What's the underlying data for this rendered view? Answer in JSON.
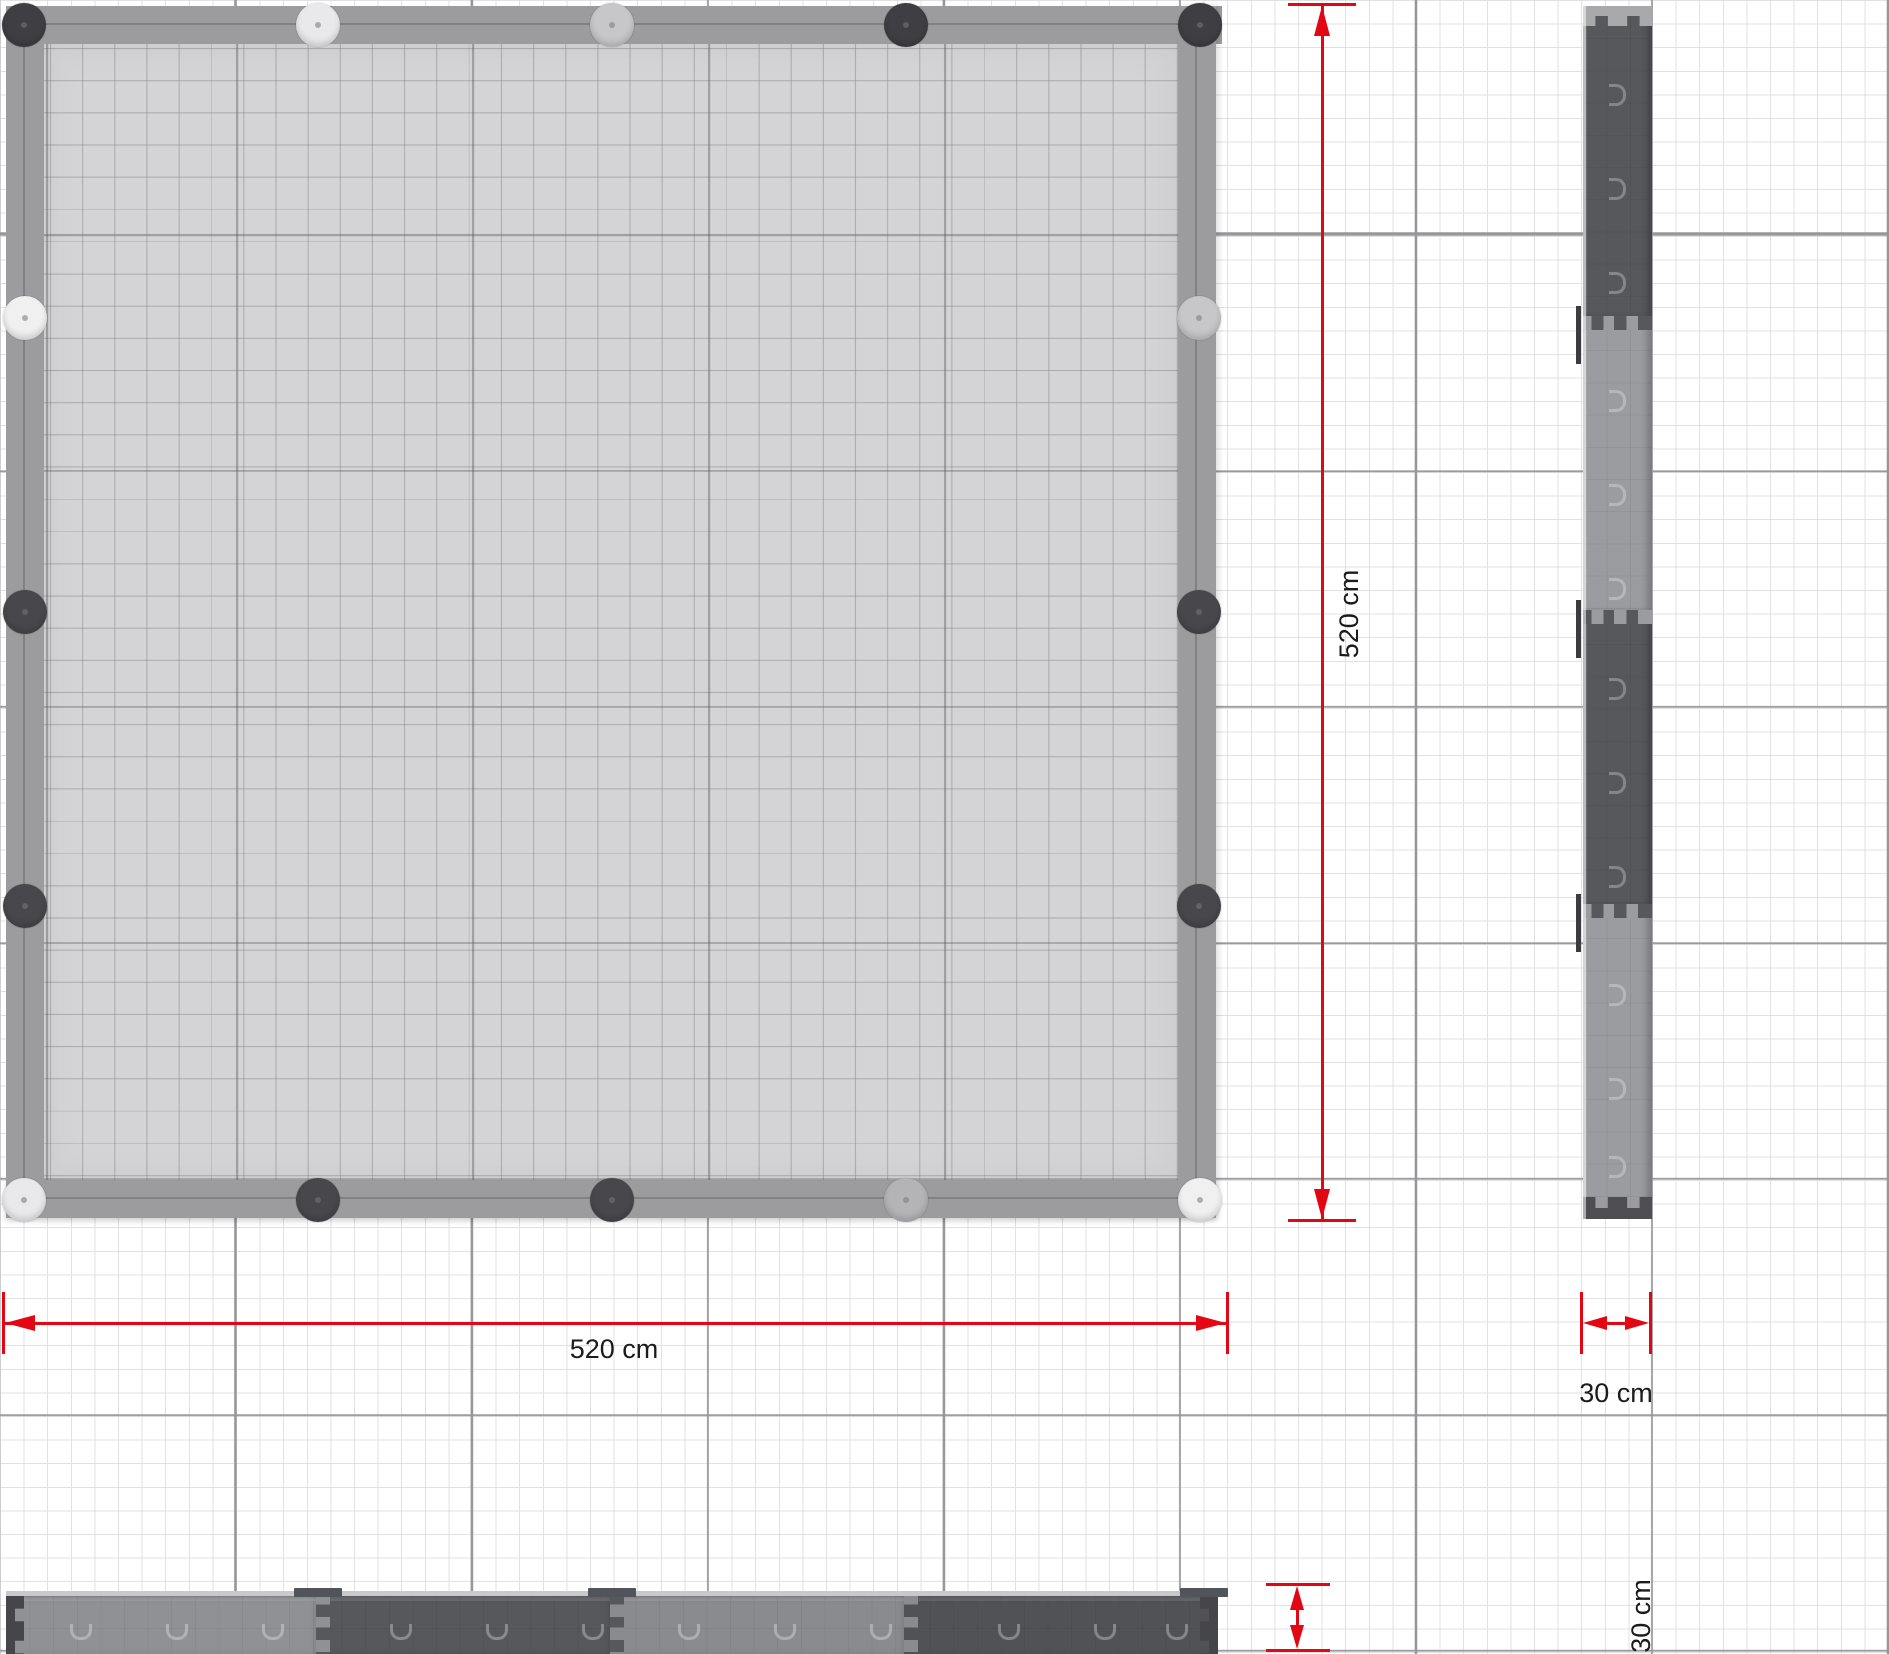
{
  "drawing": {
    "kind": "dimensioned plan drawing",
    "views": {
      "plan": "top view 520 x 520 cm",
      "side": "side elevation 30 cm wide",
      "front": "front elevation 30 cm high"
    }
  },
  "dimensions": {
    "plan_height": {
      "label": "520 cm"
    },
    "plan_width": {
      "label": "520 cm"
    },
    "side_width": {
      "label": "30 cm"
    },
    "front_height": {
      "label": "30 cm"
    }
  },
  "colors": {
    "dimension_red": "#e30613",
    "label_text": "#1b1b1b",
    "frame_gray": "#9c9c9e",
    "deck_gray": "#d4d4d6",
    "grid_major": "#97979a",
    "grid_fine": "#e1e1e4",
    "post_dark": "#3f3f43",
    "post_dark2": "#48484c",
    "post_bright": "#f0f0f1",
    "post_light": "#e9e9eb",
    "post_ltgray": "#c7c7c9",
    "post_mid": "#b4b4b6",
    "board_dark": "#57585c",
    "board_dark2": "#515256",
    "board_light": "#9b9c9f",
    "board_light2": "#909194",
    "board_mid": "#8a8b8e"
  },
  "plan": {
    "posts": [
      {
        "x": 24,
        "y": 25,
        "color_key": "post_dark"
      },
      {
        "x": 318,
        "y": 25,
        "color_key": "post_light"
      },
      {
        "x": 612,
        "y": 25,
        "color_key": "post_ltgray"
      },
      {
        "x": 906,
        "y": 25,
        "color_key": "post_dark"
      },
      {
        "x": 1200,
        "y": 25,
        "color_key": "post_dark"
      },
      {
        "x": 1199,
        "y": 318,
        "color_key": "post_ltgray"
      },
      {
        "x": 1199,
        "y": 612,
        "color_key": "post_dark2"
      },
      {
        "x": 1199,
        "y": 906,
        "color_key": "post_dark2"
      },
      {
        "x": 1200,
        "y": 1200,
        "color_key": "post_bright"
      },
      {
        "x": 906,
        "y": 1200,
        "color_key": "post_mid"
      },
      {
        "x": 612,
        "y": 1200,
        "color_key": "post_dark2"
      },
      {
        "x": 318,
        "y": 1200,
        "color_key": "post_dark2"
      },
      {
        "x": 24,
        "y": 1200,
        "color_key": "post_light"
      },
      {
        "x": 25,
        "y": 318,
        "color_key": "post_bright"
      },
      {
        "x": 25,
        "y": 612,
        "color_key": "post_dark2"
      },
      {
        "x": 25,
        "y": 906,
        "color_key": "post_dark2"
      }
    ]
  },
  "side_view": {
    "boards": [
      {
        "from": 0,
        "to": 312,
        "color_key": "board_dark"
      },
      {
        "from": 312,
        "to": 606,
        "color_key": "board_light"
      },
      {
        "from": 606,
        "to": 900,
        "color_key": "board_dark"
      },
      {
        "from": 900,
        "to": 1213,
        "color_key": "board_light"
      }
    ],
    "joints": [
      {
        "pos": 312,
        "upper_key": "board_dark",
        "lower_key": "board_light"
      },
      {
        "pos": 606,
        "upper_key": "board_light",
        "lower_key": "board_dark"
      },
      {
        "pos": 900,
        "upper_key": "board_dark",
        "lower_key": "board_light"
      }
    ],
    "clip_positions": [
      300,
      594,
      888
    ],
    "moon_positions": [
      78,
      172,
      266,
      384,
      478,
      572,
      672,
      766,
      860,
      978,
      1072,
      1150
    ]
  },
  "front_view": {
    "boards": [
      {
        "from": 0,
        "to": 312,
        "color_key": "board_light2"
      },
      {
        "from": 312,
        "to": 606,
        "color_key": "board_dark"
      },
      {
        "from": 606,
        "to": 900,
        "color_key": "board_mid"
      },
      {
        "from": 900,
        "to": 1212,
        "color_key": "board_dark2"
      }
    ],
    "joints": [
      {
        "pos": 312,
        "left_key": "board_light2",
        "right_key": "board_dark"
      },
      {
        "pos": 606,
        "left_key": "board_dark",
        "right_key": "board_mid"
      },
      {
        "pos": 900,
        "left_key": "board_mid",
        "right_key": "board_dark2"
      }
    ],
    "tab_positions": [
      312,
      606,
      1198
    ],
    "moon_positions": [
      64,
      160,
      256,
      384,
      480,
      576,
      672,
      768,
      864,
      992,
      1088,
      1160
    ]
  }
}
